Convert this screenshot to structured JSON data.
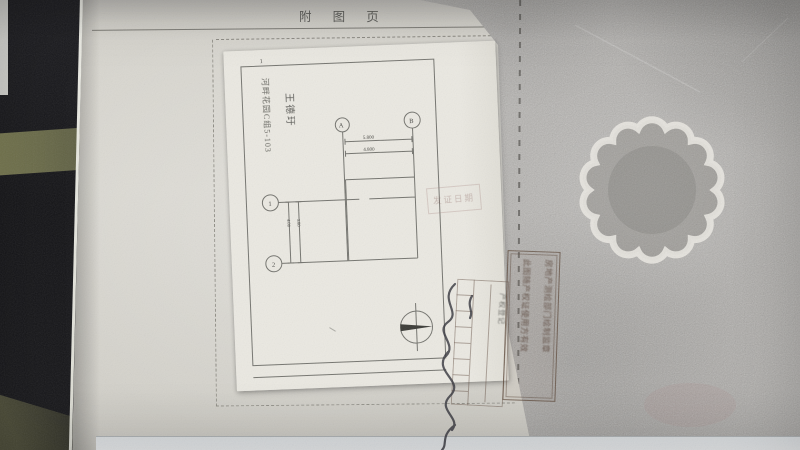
{
  "page": {
    "header_title": "附 图 页",
    "page_number": "1",
    "paper_color": "#d8d6cf",
    "sheet_color": "#eae8e1",
    "cover_color": "#b6b4b1"
  },
  "plan": {
    "owner_name": "王德玗",
    "address": "河畔花园C组5-103",
    "axis_a": "A",
    "axis_b": "B",
    "axis_1": "1",
    "axis_2": "2",
    "dim_top_outer": "5.800",
    "dim_top_inner": "4.800",
    "dim_left_outer": "4.00",
    "dim_left_inner": "3.80"
  },
  "stamps": {
    "faint_stamp_text": "发证日期",
    "grid_stamp_label": "产权登记",
    "long_stamp_col1": "此图随产权证使用方有效",
    "long_stamp_col2": "房地产测绘部门绘制监章",
    "ink_color": "#6e5d55"
  },
  "signature": {
    "ink_color": "#34343c"
  },
  "photo": {
    "background_color": "#17171b",
    "olive_band_color": "#6f7052",
    "table_edge_color": "#eef0f2"
  }
}
